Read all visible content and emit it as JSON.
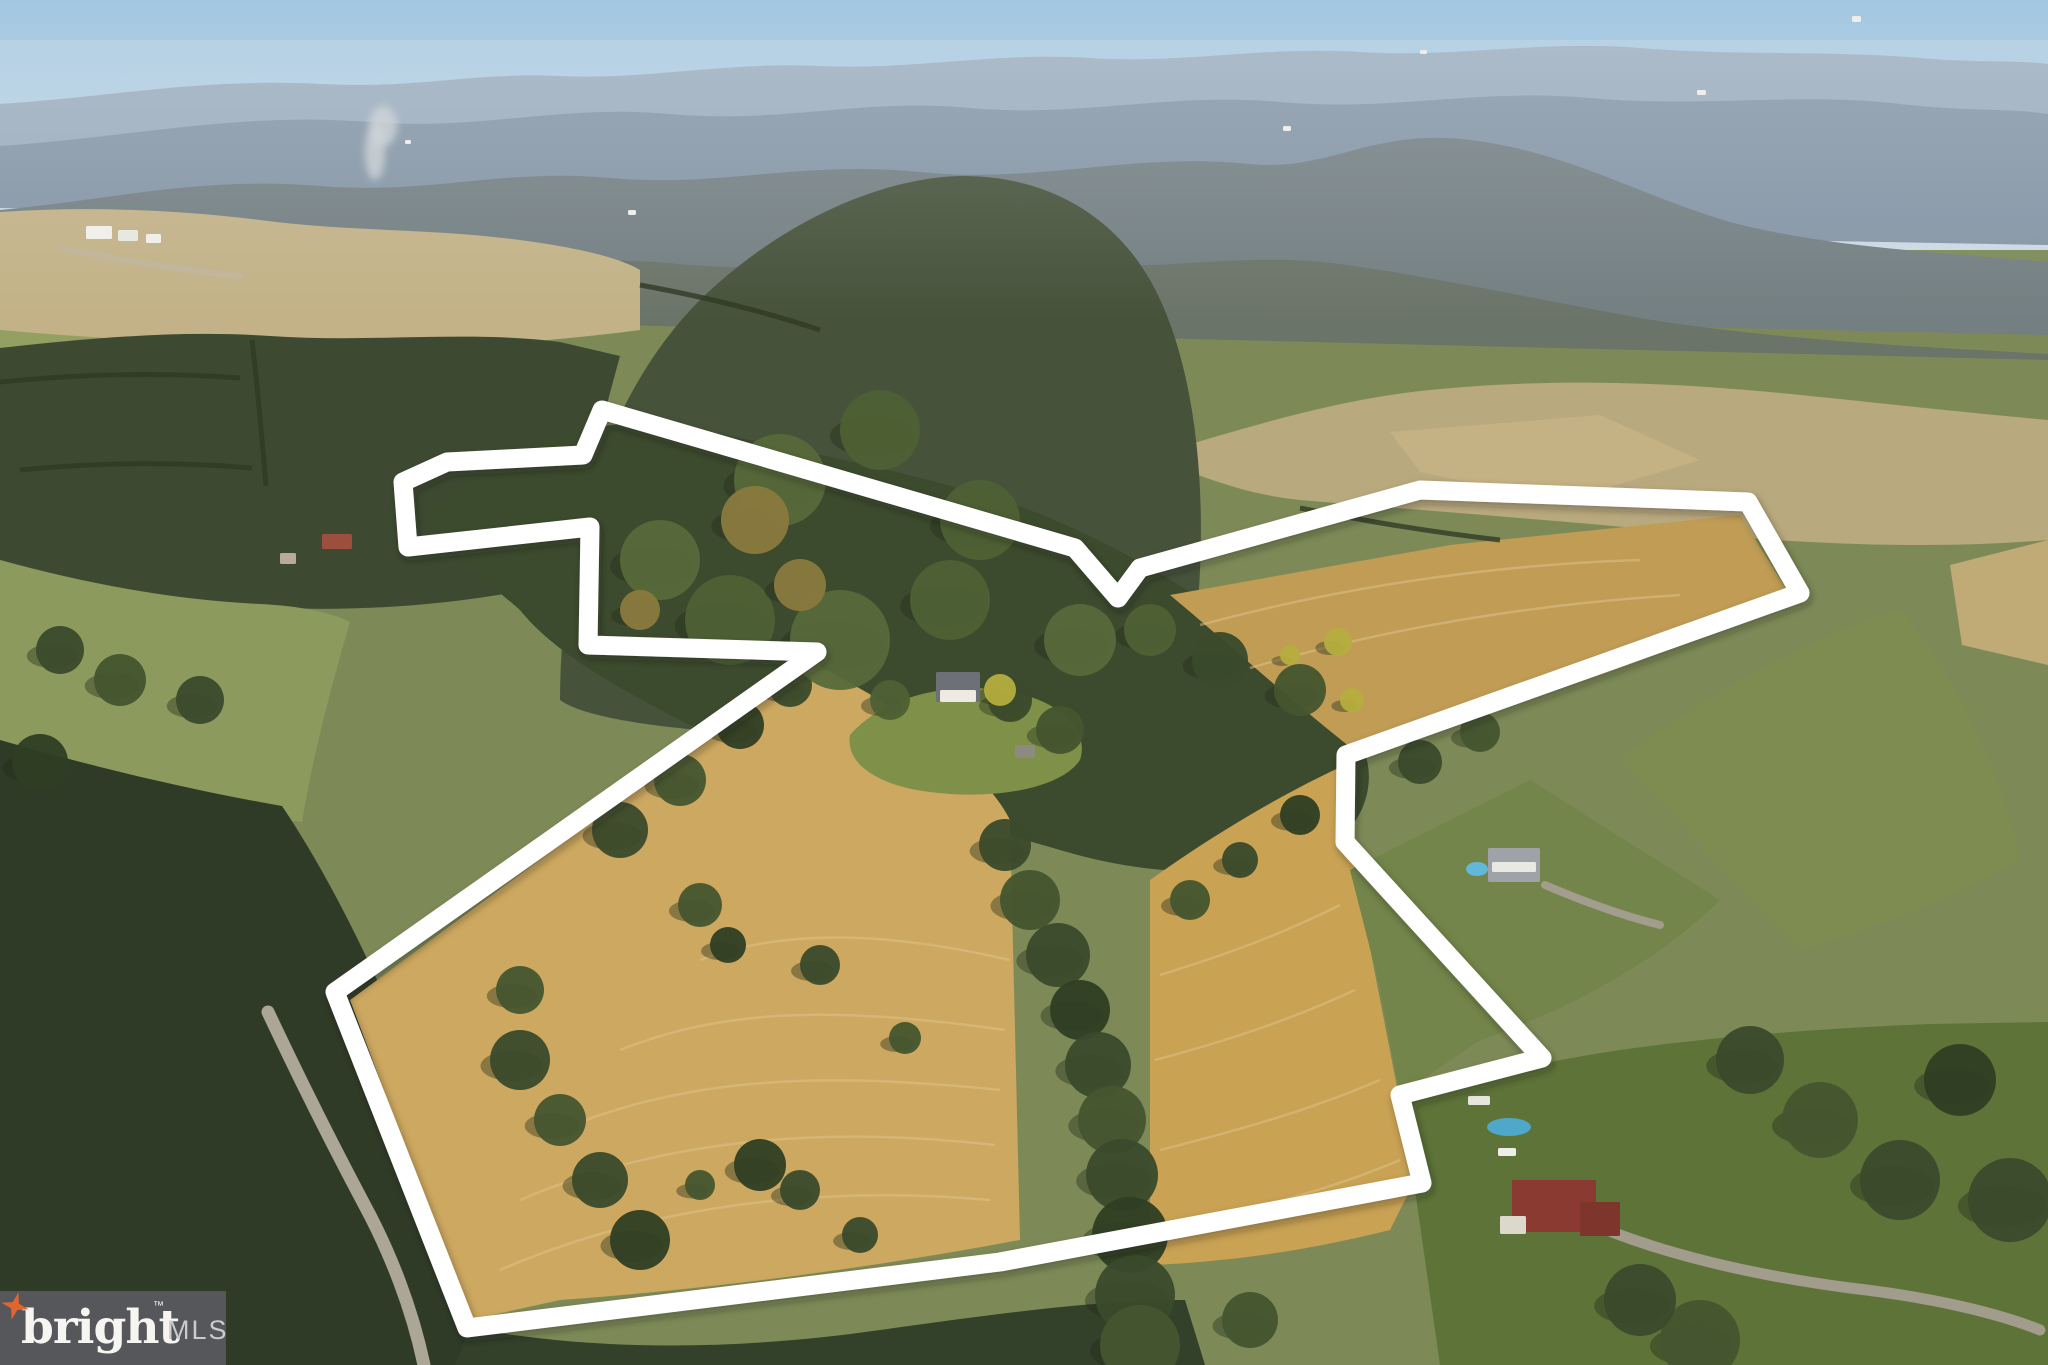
{
  "watermark": {
    "brand": "bright",
    "tm": "™",
    "suffix": "MLS",
    "bg_color": "#56575a",
    "brand_color": "#f7f5f1",
    "suffix_color": "#c9cbcd",
    "star_color": "#e0662f"
  },
  "scene": {
    "sky_top": "#a3c7e2",
    "sky_bottom": "#cbdae3",
    "boundary": {
      "color": "#ffffff",
      "stroke_width": 19,
      "points": [
        [
          602,
          410
        ],
        [
          1075,
          548
        ],
        [
          1118,
          598
        ],
        [
          1140,
          568
        ],
        [
          1420,
          490
        ],
        [
          1748,
          502
        ],
        [
          1800,
          593
        ],
        [
          1346,
          755
        ],
        [
          1345,
          842
        ],
        [
          1542,
          1058
        ],
        [
          1400,
          1095
        ],
        [
          1422,
          1183
        ],
        [
          1000,
          1262
        ],
        [
          467,
          1328
        ],
        [
          335,
          992
        ],
        [
          817,
          652
        ],
        [
          588,
          645
        ],
        [
          590,
          527
        ],
        [
          408,
          547
        ],
        [
          403,
          482
        ],
        [
          447,
          462
        ],
        [
          583,
          455
        ]
      ]
    },
    "terrain": [
      {
        "name": "far-ridge",
        "fill": "#9aaabb",
        "opacity": 0.95,
        "d": "M0,150 L0,104 C120,96 200,78 320,84 C420,89 470,72 560,76 C650,80 720,62 820,66 C920,70 990,52 1090,58 C1190,64 1260,46 1360,52 C1460,58 1540,40 1640,48 C1740,56 1830,50 1920,58 C1980,63 2020,60 2048,64 L2048,175 Z"
      },
      {
        "name": "mid-ridge",
        "fill": "#8595a5",
        "opacity": 1,
        "d": "M0,208 L0,146 C140,136 240,112 370,122 C480,131 560,104 670,114 C780,124 860,98 970,108 C1080,118 1170,92 1280,102 C1390,112 1480,88 1590,98 C1700,108 1800,92 1900,104 C1970,112 2010,108 2048,114 L2048,245 Z"
      },
      {
        "name": "near-ridge",
        "fill": "#747f82",
        "opacity": 1,
        "d": "M0,290 L0,210 C110,200 200,176 320,186 C430,195 500,168 610,178 C720,188 800,160 920,172 C1040,184 1130,152 1250,164 C1330,172 1370,128 1470,140 C1570,152 1640,196 1730,222 C1820,246 1930,252 2048,262 L2048,335 Z"
      },
      {
        "name": "olive-hills",
        "fill": "#6b7468",
        "opacity": 1,
        "d": "M0,360 L0,290 C130,278 230,258 350,268 C470,278 560,252 680,264 C800,276 900,248 1020,262 C1140,276 1240,250 1340,264 C1440,278 1540,300 1640,318 C1760,338 1900,346 2048,354 L2048,430 Z"
      },
      {
        "name": "valley-base",
        "fill": "#7d8a57",
        "opacity": 1,
        "d": "M0,1365 L0,310 L2048,360 L2048,1365 Z"
      },
      {
        "name": "top-left-fields",
        "fill": "#c3b287",
        "opacity": 1,
        "d": "M0,330 L0,212 C90,206 180,210 260,220 C350,232 430,228 520,240 C580,248 620,258 640,270 L640,330 C520,346 380,352 240,348 C150,345 70,338 0,330 Z"
      },
      {
        "name": "top-left-pasture",
        "fill": "#93a061",
        "opacity": 1,
        "d": "M0,560 L0,330 C90,338 200,344 300,348 C360,350 420,356 470,366 C450,430 430,500 420,560 C300,580 150,575 0,560 Z"
      },
      {
        "name": "top-right-fields",
        "fill": "#b9a97e",
        "opacity": 1,
        "d": "M1150,456 C1240,430 1330,400 1430,390 C1550,378 1660,382 1770,392 C1870,402 1960,412 2048,420 L2048,540 C1930,550 1800,544 1680,532 C1550,520 1420,510 1300,500 C1240,494 1190,472 1150,456 Z"
      },
      {
        "name": "top-right-golden-field",
        "fill": "#c4b184",
        "opacity": 1,
        "d": "M1390,432 L1600,415 L1700,460 L1560,502 L1420,472 Z"
      },
      {
        "name": "right-edge-field",
        "fill": "#c0ab77",
        "opacity": 1,
        "d": "M1950,565 L2048,540 L2048,665 L1962,645 Z"
      },
      {
        "name": "left-mid-forest",
        "fill": "#3d4a31",
        "opacity": 1,
        "d": "M0,560 L0,348 C90,338 180,330 270,336 C370,343 470,330 560,342 L620,356 C600,430 580,500 575,580 C480,602 380,612 280,608 C180,604 90,585 0,560 Z"
      },
      {
        "name": "central-mountain-forest",
        "fill": "#46523a",
        "opacity": 1,
        "d": "M560,700 C560,560 600,400 700,300 C780,222 880,178 960,176 C1040,175 1110,210 1150,280 C1190,350 1205,460 1200,570 C1197,650 1180,700 1150,730 L700,730 C640,725 580,715 560,700 Z"
      },
      {
        "name": "interior-forest",
        "fill": "#3c4a2d",
        "opacity": 1,
        "d": "M420,520 C520,430 610,412 700,430 C800,450 900,470 1000,500 C1100,530 1250,620 1330,700 C1380,748 1380,800 1340,840 C1260,880 1160,880 1060,850 C940,815 820,790 720,740 C640,700 560,660 520,610 C480,575 440,550 420,520 Z"
      },
      {
        "name": "left-pasture-low",
        "fill": "#8d9a5e",
        "opacity": 1,
        "d": "M0,780 L0,560 C80,582 170,600 260,604 C300,606 330,612 350,622 C330,690 312,760 302,822 C220,812 110,796 0,780 Z"
      },
      {
        "name": "left-lower-forest",
        "fill": "#2f3b27",
        "opacity": 1,
        "d": "M0,1365 L0,740 C90,766 190,790 282,806 C332,880 380,980 420,1080 C450,1160 470,1250 480,1365 Z"
      },
      {
        "name": "field-west",
        "fill": "#cda860",
        "opacity": 1,
        "d": "M350,1000 L810,660 L880,700 C940,740 990,780 1010,820 L1020,1240 C860,1270 700,1290 560,1300 L470,1320 Z"
      },
      {
        "name": "field-east",
        "fill": "#c9a254",
        "opacity": 1,
        "d": "M1150,880 C1220,830 1290,790 1345,765 L1350,845 L1415,1180 L1390,1230 C1310,1250 1230,1262 1150,1265 Z"
      },
      {
        "name": "field-northeast",
        "fill": "#c09c55",
        "opacity": 1,
        "d": "M1170,595 L1450,545 L1740,515 L1788,592 C1700,640 1600,680 1500,705 L1360,755 C1290,700 1230,645 1170,595 Z"
      },
      {
        "name": "farmhouse-lawn",
        "fill": "#7f9148",
        "opacity": 1,
        "d": "M850,735 C880,700 940,682 1000,690 C1060,698 1090,730 1080,760 C1060,790 990,800 930,792 C880,786 845,765 850,735 Z"
      },
      {
        "name": "right-upper-pasture",
        "fill": "#7e8c52",
        "opacity": 1,
        "d": "M1620,760 C1700,700 1800,640 1900,610 C1960,680 2000,770 2020,860 C1950,900 1870,930 1800,950 C1740,890 1680,820 1620,760 Z"
      },
      {
        "name": "right-mid-pasture",
        "fill": "#73854a",
        "opacity": 1,
        "d": "M1350,870 L1530,780 L1720,900 C1660,960 1570,1010 1480,1040 L1400,1095 L1378,980 Z"
      },
      {
        "name": "right-lawn",
        "fill": "#5d7338",
        "opacity": 1,
        "d": "M1440,1365 L1415,1190 L1398,1100 C1460,1080 1540,1062 1620,1050 C1720,1036 1830,1028 1930,1024 L2048,1022 L2048,1365 Z"
      },
      {
        "name": "bottom-forest-band",
        "fill": "#33402a",
        "opacity": 1,
        "d": "M455,1365 L470,1328 C600,1352 740,1350 880,1330 C1000,1313 1100,1300 1185,1300 L1205,1365 Z"
      },
      {
        "name": "haze",
        "fill": "url(#hazeGrad)",
        "opacity": 0.28,
        "d": "M0,40 L2048,40 L2048,320 L0,320 Z"
      }
    ],
    "mow_lines": {
      "stroke": "#e0c489",
      "paths": [
        "M500,1270 C650,1205 820,1185 990,1200",
        "M520,1200 C660,1140 820,1125 995,1145",
        "M560,1130 C680,1080 810,1070 1000,1090",
        "M620,1050 C720,1010 830,1005 1005,1030",
        "M700,960 C780,930 880,930 1010,960",
        "M1165,1230 C1250,1210 1330,1190 1400,1160",
        "M1160,1150 C1240,1130 1310,1110 1380,1080",
        "M1155,1060 C1230,1040 1290,1020 1355,990",
        "M1160,975 C1225,955 1280,935 1340,905",
        "M1200,625 C1330,590 1480,565 1640,560",
        "M1250,668 C1380,630 1520,605 1680,595"
      ]
    },
    "hedgerows": {
      "stroke": "#2f3a26",
      "paths": [
        "M0,382 C80,374 160,372 240,378",
        "M20,470 C100,462 180,462 252,468",
        "M252,340 C258,390 262,440 266,486",
        "M640,285 C700,296 760,310 820,330",
        "M1300,508 C1360,520 1430,532 1500,540"
      ]
    },
    "roads": [
      {
        "name": "country-road",
        "stroke": "#b3ac9c",
        "width": 13,
        "d": "M268,1012 C300,1080 330,1140 364,1204 C390,1252 412,1308 424,1365"
      },
      {
        "name": "estate-driveway",
        "stroke": "#a49e90",
        "width": 11,
        "d": "M1612,1232 C1680,1258 1760,1276 1850,1288 C1920,1296 1990,1310 2040,1330"
      },
      {
        "name": "house-driveway",
        "stroke": "#a49e90",
        "width": 8,
        "d": "M1545,885 C1580,900 1620,915 1660,925"
      },
      {
        "name": "farm-track",
        "stroke": "#c2b79e",
        "width": 6,
        "d": "M60,248 C120,260 180,270 240,276"
      }
    ],
    "trees": [
      {
        "x": 1005,
        "y": 845,
        "r": 26,
        "c": 0
      },
      {
        "x": 1030,
        "y": 900,
        "r": 30,
        "c": 1
      },
      {
        "x": 1058,
        "y": 955,
        "r": 32,
        "c": 0
      },
      {
        "x": 1080,
        "y": 1010,
        "r": 30,
        "c": 2
      },
      {
        "x": 1098,
        "y": 1065,
        "r": 33,
        "c": 0
      },
      {
        "x": 1112,
        "y": 1120,
        "r": 34,
        "c": 1
      },
      {
        "x": 1122,
        "y": 1175,
        "r": 36,
        "c": 0
      },
      {
        "x": 1130,
        "y": 1235,
        "r": 38,
        "c": 2
      },
      {
        "x": 1135,
        "y": 1295,
        "r": 40,
        "c": 0
      },
      {
        "x": 1140,
        "y": 1345,
        "r": 40,
        "c": 1
      },
      {
        "x": 700,
        "y": 905,
        "r": 22,
        "c": 1
      },
      {
        "x": 728,
        "y": 945,
        "r": 18,
        "c": 2
      },
      {
        "x": 820,
        "y": 965,
        "r": 20,
        "c": 0
      },
      {
        "x": 905,
        "y": 1038,
        "r": 16,
        "c": 1
      },
      {
        "x": 760,
        "y": 1165,
        "r": 26,
        "c": 2
      },
      {
        "x": 800,
        "y": 1190,
        "r": 20,
        "c": 0
      },
      {
        "x": 700,
        "y": 1185,
        "r": 15,
        "c": 1
      },
      {
        "x": 860,
        "y": 1235,
        "r": 18,
        "c": 0
      },
      {
        "x": 520,
        "y": 1060,
        "r": 30,
        "c": 0
      },
      {
        "x": 560,
        "y": 1120,
        "r": 26,
        "c": 1
      },
      {
        "x": 600,
        "y": 1180,
        "r": 28,
        "c": 0
      },
      {
        "x": 640,
        "y": 1240,
        "r": 30,
        "c": 2
      },
      {
        "x": 520,
        "y": 990,
        "r": 24,
        "c": 1
      },
      {
        "x": 620,
        "y": 830,
        "r": 28,
        "c": 0
      },
      {
        "x": 680,
        "y": 780,
        "r": 26,
        "c": 1
      },
      {
        "x": 740,
        "y": 725,
        "r": 24,
        "c": 2
      },
      {
        "x": 790,
        "y": 685,
        "r": 22,
        "c": 0
      },
      {
        "x": 1190,
        "y": 900,
        "r": 20,
        "c": 1
      },
      {
        "x": 1240,
        "y": 860,
        "r": 18,
        "c": 0
      },
      {
        "x": 1300,
        "y": 815,
        "r": 20,
        "c": 2
      },
      {
        "x": 1420,
        "y": 762,
        "r": 22,
        "c": 0
      },
      {
        "x": 1480,
        "y": 732,
        "r": 20,
        "c": 1
      },
      {
        "x": 890,
        "y": 700,
        "r": 20,
        "c": 3
      },
      {
        "x": 1010,
        "y": 700,
        "r": 22,
        "c": 0
      },
      {
        "x": 1060,
        "y": 730,
        "r": 24,
        "c": 1
      },
      {
        "x": 1150,
        "y": 630,
        "r": 26,
        "c": 3
      },
      {
        "x": 1220,
        "y": 660,
        "r": 28,
        "c": 0
      },
      {
        "x": 1300,
        "y": 690,
        "r": 26,
        "c": 1
      },
      {
        "x": 1750,
        "y": 1060,
        "r": 34,
        "c": 0
      },
      {
        "x": 1820,
        "y": 1120,
        "r": 38,
        "c": 1
      },
      {
        "x": 1900,
        "y": 1180,
        "r": 40,
        "c": 0
      },
      {
        "x": 1960,
        "y": 1080,
        "r": 36,
        "c": 2
      },
      {
        "x": 2010,
        "y": 1200,
        "r": 42,
        "c": 0
      },
      {
        "x": 1700,
        "y": 1340,
        "r": 40,
        "c": 1
      },
      {
        "x": 1640,
        "y": 1300,
        "r": 36,
        "c": 0
      },
      {
        "x": 1250,
        "y": 1320,
        "r": 28,
        "c": 1
      },
      {
        "x": 60,
        "y": 650,
        "r": 24,
        "c": 0
      },
      {
        "x": 120,
        "y": 680,
        "r": 26,
        "c": 1
      },
      {
        "x": 200,
        "y": 700,
        "r": 24,
        "c": 0
      },
      {
        "x": 40,
        "y": 762,
        "r": 28,
        "c": 2
      },
      {
        "x": 660,
        "y": 560,
        "r": 40,
        "c": 4
      },
      {
        "x": 730,
        "y": 620,
        "r": 45,
        "c": 3
      },
      {
        "x": 840,
        "y": 640,
        "r": 50,
        "c": 4
      },
      {
        "x": 950,
        "y": 600,
        "r": 40,
        "c": 3
      },
      {
        "x": 780,
        "y": 480,
        "r": 46,
        "c": 4
      },
      {
        "x": 880,
        "y": 430,
        "r": 40,
        "c": 3
      },
      {
        "x": 1080,
        "y": 640,
        "r": 36,
        "c": 4
      },
      {
        "x": 980,
        "y": 520,
        "r": 40,
        "c": 3
      },
      {
        "x": 755,
        "y": 520,
        "r": 34,
        "c": 5
      },
      {
        "x": 800,
        "y": 585,
        "r": 26,
        "c": 5
      },
      {
        "x": 640,
        "y": 610,
        "r": 20,
        "c": 5
      },
      {
        "x": 1000,
        "y": 690,
        "r": 16,
        "c": 6
      },
      {
        "x": 1338,
        "y": 642,
        "r": 14,
        "c": 6
      },
      {
        "x": 1352,
        "y": 700,
        "r": 12,
        "c": 6
      },
      {
        "x": 1290,
        "y": 655,
        "r": 10,
        "c": 6
      }
    ],
    "tree_palette": [
      "#3a4a2b",
      "#44552f",
      "#2f3e23",
      "#4e6034",
      "#57693a",
      "#8a7a3e",
      "#b5ad3e"
    ],
    "structures": [
      {
        "name": "farm-building",
        "x": 86,
        "y": 226,
        "w": 26,
        "h": 13,
        "fill": "#f0efe9"
      },
      {
        "name": "farm-building",
        "x": 118,
        "y": 230,
        "w": 20,
        "h": 11,
        "fill": "#e8e7e0"
      },
      {
        "name": "farm-building",
        "x": 146,
        "y": 234,
        "w": 15,
        "h": 9,
        "fill": "#f0efe9"
      },
      {
        "name": "red-roof-barn",
        "x": 322,
        "y": 534,
        "w": 30,
        "h": 15,
        "fill": "#9c4f3c"
      },
      {
        "name": "small-house",
        "x": 280,
        "y": 553,
        "w": 16,
        "h": 11,
        "fill": "#b9ab97"
      },
      {
        "name": "farmhouse-roof",
        "x": 936,
        "y": 672,
        "w": 44,
        "h": 30,
        "fill": "#6d7177"
      },
      {
        "name": "farmhouse-front",
        "x": 940,
        "y": 690,
        "w": 36,
        "h": 12,
        "fill": "#eceae2"
      },
      {
        "name": "farm-shed",
        "x": 1015,
        "y": 745,
        "w": 20,
        "h": 13,
        "fill": "#8d8a80"
      },
      {
        "name": "neighbor-house",
        "x": 1488,
        "y": 848,
        "w": 52,
        "h": 34,
        "fill": "#9fa3a8"
      },
      {
        "name": "neighbor-house-roofline",
        "x": 1492,
        "y": 862,
        "w": 44,
        "h": 10,
        "fill": "#e9e9e4"
      },
      {
        "name": "estate-house-main",
        "x": 1512,
        "y": 1180,
        "w": 84,
        "h": 52,
        "fill": "#8a3a30"
      },
      {
        "name": "estate-house-wing",
        "x": 1580,
        "y": 1202,
        "w": 40,
        "h": 34,
        "fill": "#7d352c"
      },
      {
        "name": "estate-porch",
        "x": 1500,
        "y": 1216,
        "w": 26,
        "h": 18,
        "fill": "#ddd8cc"
      },
      {
        "name": "estate-trailer",
        "x": 1498,
        "y": 1148,
        "w": 18,
        "h": 8,
        "fill": "#eeeee8"
      },
      {
        "name": "estate-trailer",
        "x": 1468,
        "y": 1096,
        "w": 22,
        "h": 9,
        "fill": "#e6e6df"
      },
      {
        "name": "valley-house",
        "x": 1283,
        "y": 126,
        "w": 8,
        "h": 5,
        "fill": "#eeeee8"
      },
      {
        "name": "valley-house",
        "x": 1697,
        "y": 90,
        "w": 9,
        "h": 5,
        "fill": "#eeeee8"
      },
      {
        "name": "valley-house",
        "x": 1852,
        "y": 16,
        "w": 9,
        "h": 6,
        "fill": "#eeeee8"
      },
      {
        "name": "valley-house",
        "x": 1420,
        "y": 50,
        "w": 7,
        "h": 4,
        "fill": "#eeeee8"
      },
      {
        "name": "valley-house",
        "x": 628,
        "y": 210,
        "w": 8,
        "h": 5,
        "fill": "#eeeee8"
      },
      {
        "name": "valley-house",
        "x": 405,
        "y": 140,
        "w": 6,
        "h": 4,
        "fill": "#eeeee8"
      }
    ],
    "pools": [
      {
        "name": "neighbor-pool",
        "cx": 1477,
        "cy": 869,
        "rx": 11,
        "ry": 7,
        "fill": "#62b8d8"
      },
      {
        "name": "estate-pool",
        "cx": 1509,
        "cy": 1127,
        "rx": 22,
        "ry": 9,
        "fill": "#4fa8c9"
      }
    ],
    "smoke": [
      {
        "cx": 375,
        "cy": 152,
        "rx": 10,
        "ry": 28
      },
      {
        "cx": 383,
        "cy": 126,
        "rx": 14,
        "ry": 20
      }
    ]
  }
}
